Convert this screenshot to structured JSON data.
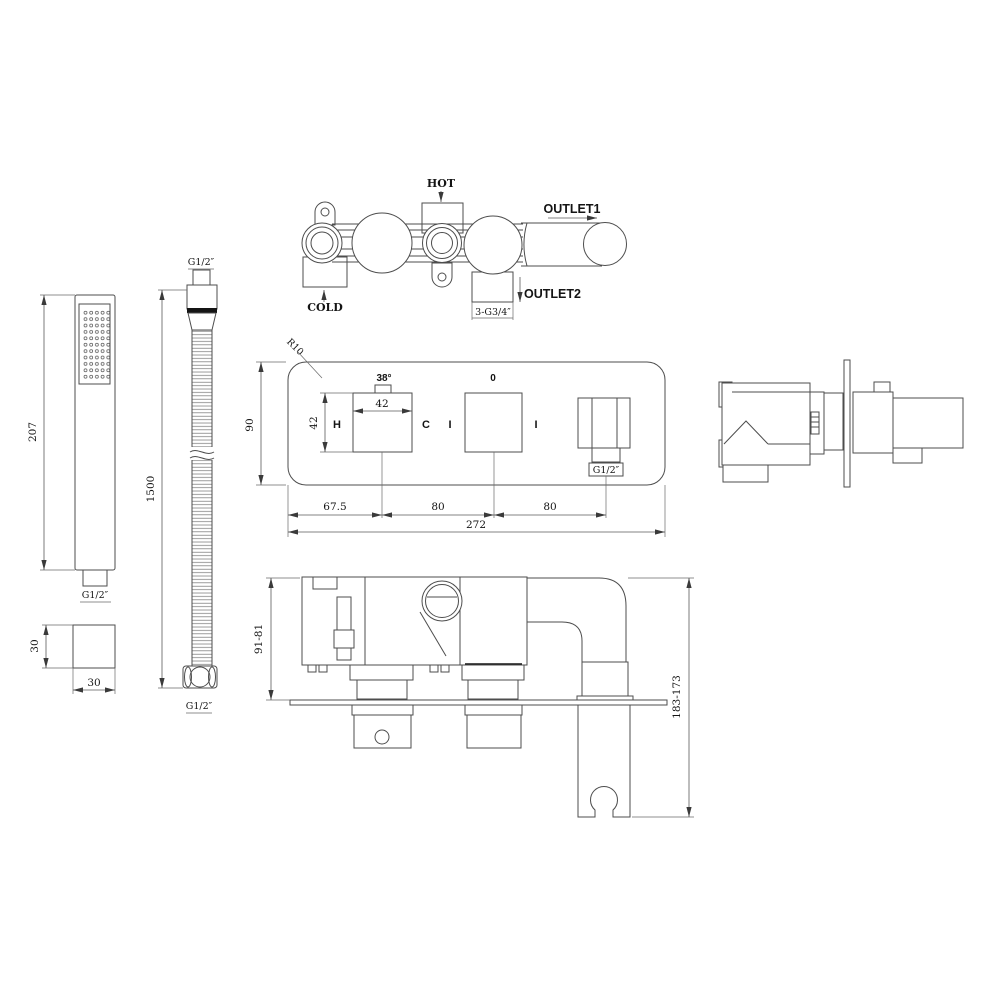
{
  "page": {
    "background": "#ffffff",
    "line_color": "#4d4d4d",
    "text_color": "#141414"
  },
  "views": {
    "hand_shower": {
      "length": "207",
      "thread": "G1/2″",
      "cross_section_height": "30",
      "cross_section_width": "30"
    },
    "hose": {
      "top_thread": "G1/2″",
      "length": "1500",
      "bottom_thread": "G1/2″"
    },
    "valve_body_top": {
      "hot": "HOT",
      "cold": "COLD",
      "outlet1": "OUTLET1",
      "outlet2": "OUTLET2",
      "outlet_thread": "3-G3/4″"
    },
    "trim_front": {
      "corner_radius": "R10",
      "temperature": "38°",
      "zero": "0",
      "hot_mark": "H",
      "cold_mark": "C",
      "tick_left": "I",
      "tick_right": "I",
      "outlet_thread": "G1/2″",
      "height": "90",
      "handle_width": "42",
      "handle_height": "42",
      "spacing_left": "67.5",
      "spacing_mid": "80",
      "spacing_right": "80",
      "total_width": "272"
    },
    "valve_installed_side": {
      "rough_in_depth": "91-81",
      "overall_depth": "183-173"
    }
  }
}
